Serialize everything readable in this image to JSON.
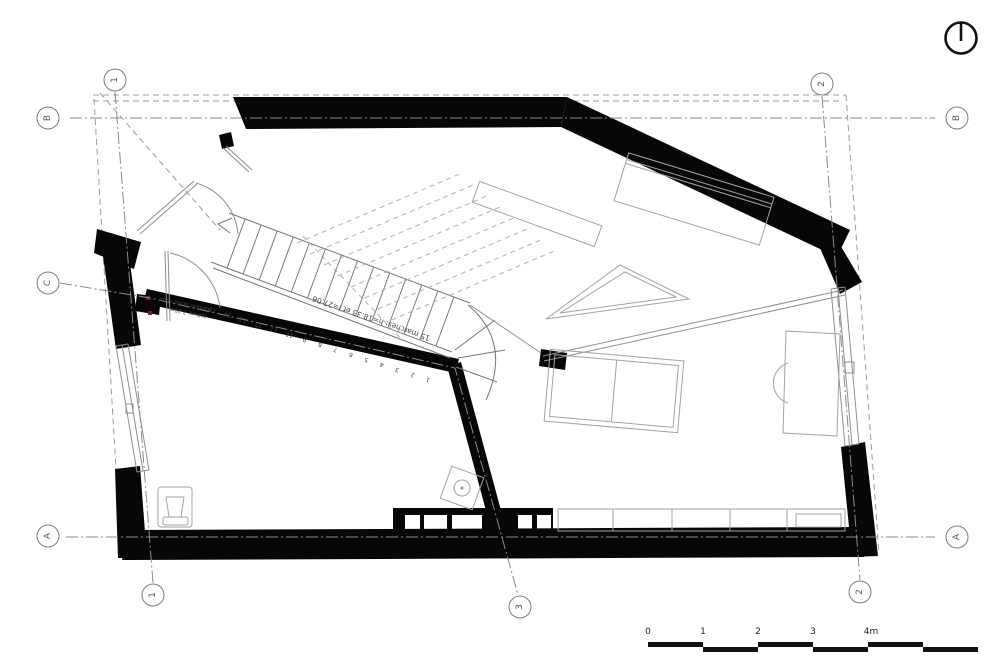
{
  "colors": {
    "wall": "#070707",
    "line": "#8f8f8f",
    "grid": "#8a8a8a",
    "dash": "#9b9b9b",
    "accent": "#7a1f1f",
    "bg": "#ffffff"
  },
  "grid_markers": [
    {
      "label": "1",
      "x": 115,
      "y": 80
    },
    {
      "label": "2",
      "x": 822,
      "y": 84
    },
    {
      "label": "B",
      "x": 48,
      "y": 118
    },
    {
      "label": "B",
      "x": 957,
      "y": 118
    },
    {
      "label": "C",
      "x": 48,
      "y": 283
    },
    {
      "label": "A",
      "x": 48,
      "y": 536
    },
    {
      "label": "A",
      "x": 957,
      "y": 537
    },
    {
      "label": "1",
      "x": 153,
      "y": 595
    },
    {
      "label": "3",
      "x": 520,
      "y": 607
    },
    {
      "label": "2",
      "x": 860,
      "y": 592
    }
  ],
  "stairs": {
    "note": "15 marches: h=18.33 et l=27.06",
    "tread_count": 15,
    "step_numbers": [
      "15",
      "14",
      "13",
      "12",
      "11",
      "10",
      "9",
      "8",
      "7",
      "6",
      "5",
      "4",
      "3",
      "2",
      "1"
    ]
  },
  "wall_note": {
    "line1": "Hauteur brute sous",
    "line2": "toiture 3.29m"
  },
  "scale_bar": {
    "labels": [
      {
        "text": "0",
        "x": 648
      },
      {
        "text": "1",
        "x": 703
      },
      {
        "text": "2",
        "x": 758
      },
      {
        "text": "3",
        "x": 813
      },
      {
        "text": "4m",
        "x": 871
      }
    ]
  },
  "north_indicator": "north-arrow"
}
